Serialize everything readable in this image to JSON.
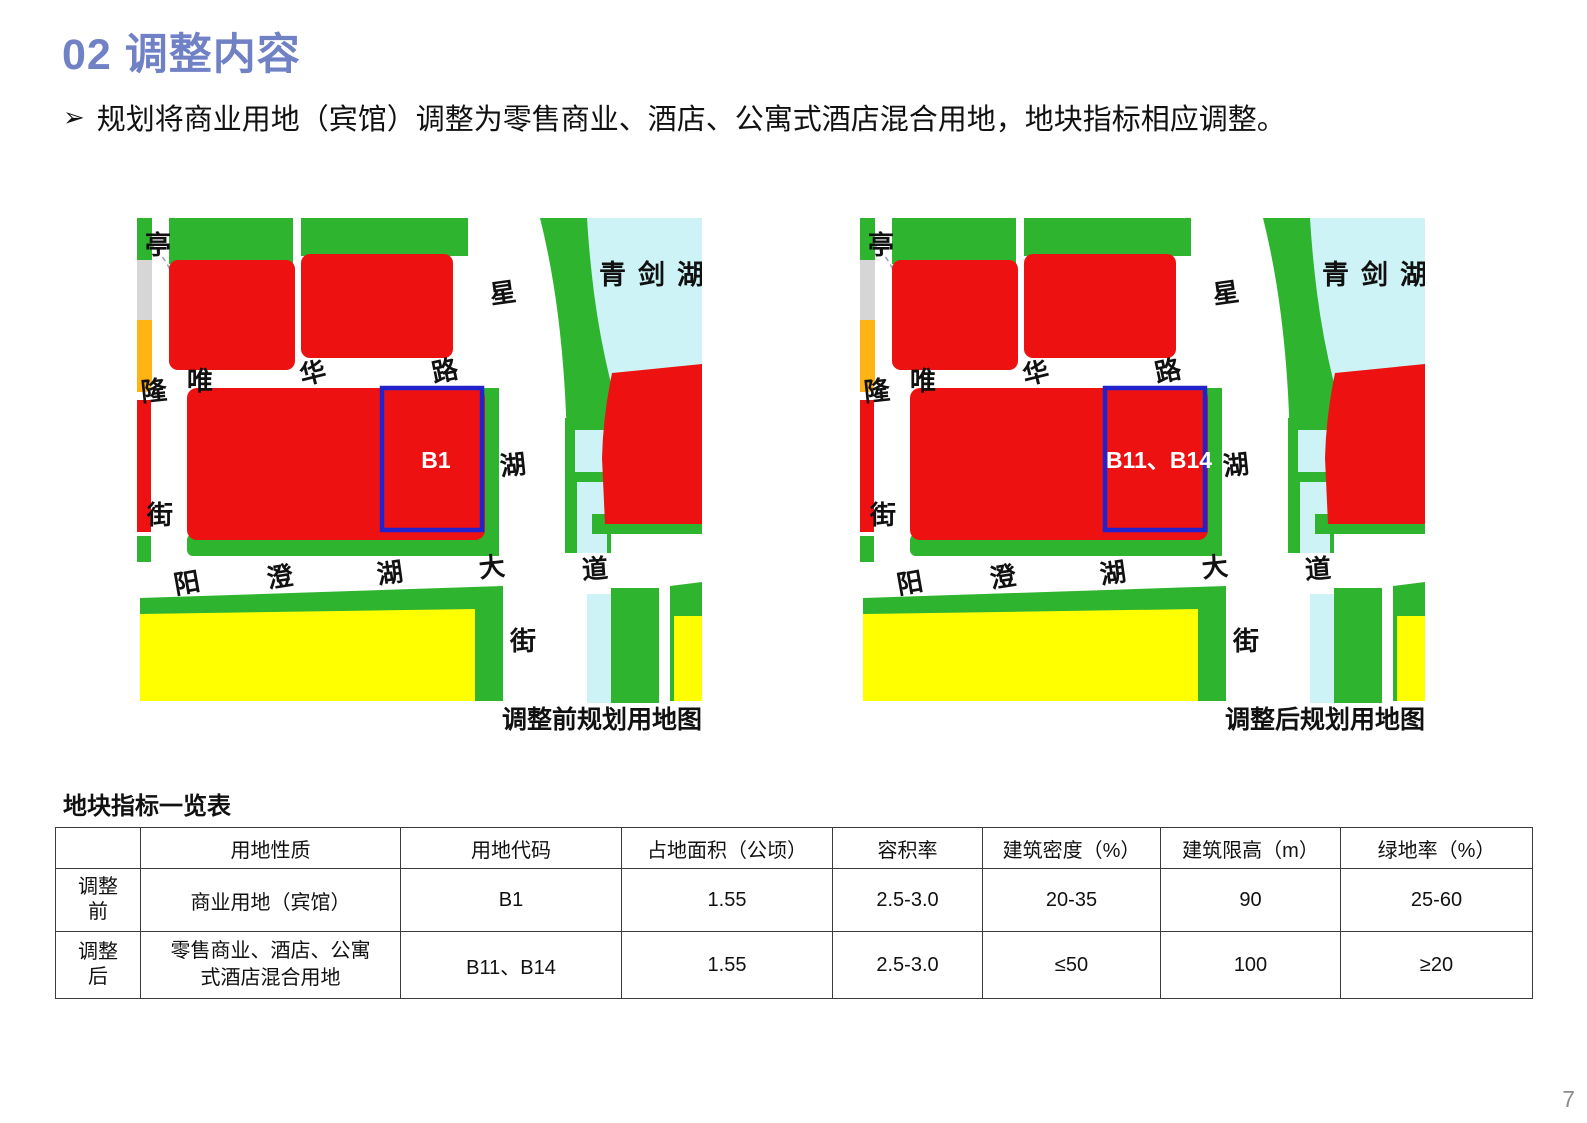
{
  "page": {
    "title": "02 调整内容",
    "bullet_marker": "➢",
    "bullet_text": "规划将商业用地（宾馆）调整为零售商业、酒店、公寓式酒店混合用地，地块指标相应调整。",
    "page_number": "7"
  },
  "maps": {
    "before": {
      "caption": "调整前规划用地图",
      "parcel_label": "B1"
    },
    "after": {
      "caption": "调整后规划用地图",
      "parcel_label": "B11、B14"
    },
    "labels": {
      "lake": "青剑湖",
      "road_left_chars": [
        "亭",
        "隆",
        "街"
      ],
      "road_top_chars": [
        "唯",
        "华",
        "路"
      ],
      "road_right_chars": [
        "星",
        "湖",
        "街"
      ],
      "road_bottom_chars": [
        "阳",
        "澄",
        "湖",
        "大",
        "道"
      ]
    },
    "colors": {
      "commercial_red": "#EE1111",
      "green_space": "#2EB42E",
      "residential_yellow": "#FFFF00",
      "water_blue": "#CDF3F7",
      "orange": "#FFB414",
      "gray": "#D6D6D6",
      "parcel_outline_blue": "#2222CC"
    }
  },
  "table": {
    "title": "地块指标一览表",
    "headers": [
      "",
      "用地性质",
      "用地代码",
      "占地面积（公顷）",
      "容积率",
      "建筑密度（%）",
      "建筑限高（m）",
      "绿地率（%）"
    ],
    "rows": [
      {
        "label": "调整前",
        "cells": [
          "商业用地（宾馆）",
          "B1",
          "1.55",
          "2.5-3.0",
          "20-35",
          "90",
          "25-60"
        ]
      },
      {
        "label": "调整后",
        "cells": [
          "零售商业、酒店、公寓式酒店混合用地",
          "B11、B14",
          "1.55",
          "2.5-3.0",
          "≤50",
          "100",
          "≥20"
        ]
      }
    ]
  }
}
